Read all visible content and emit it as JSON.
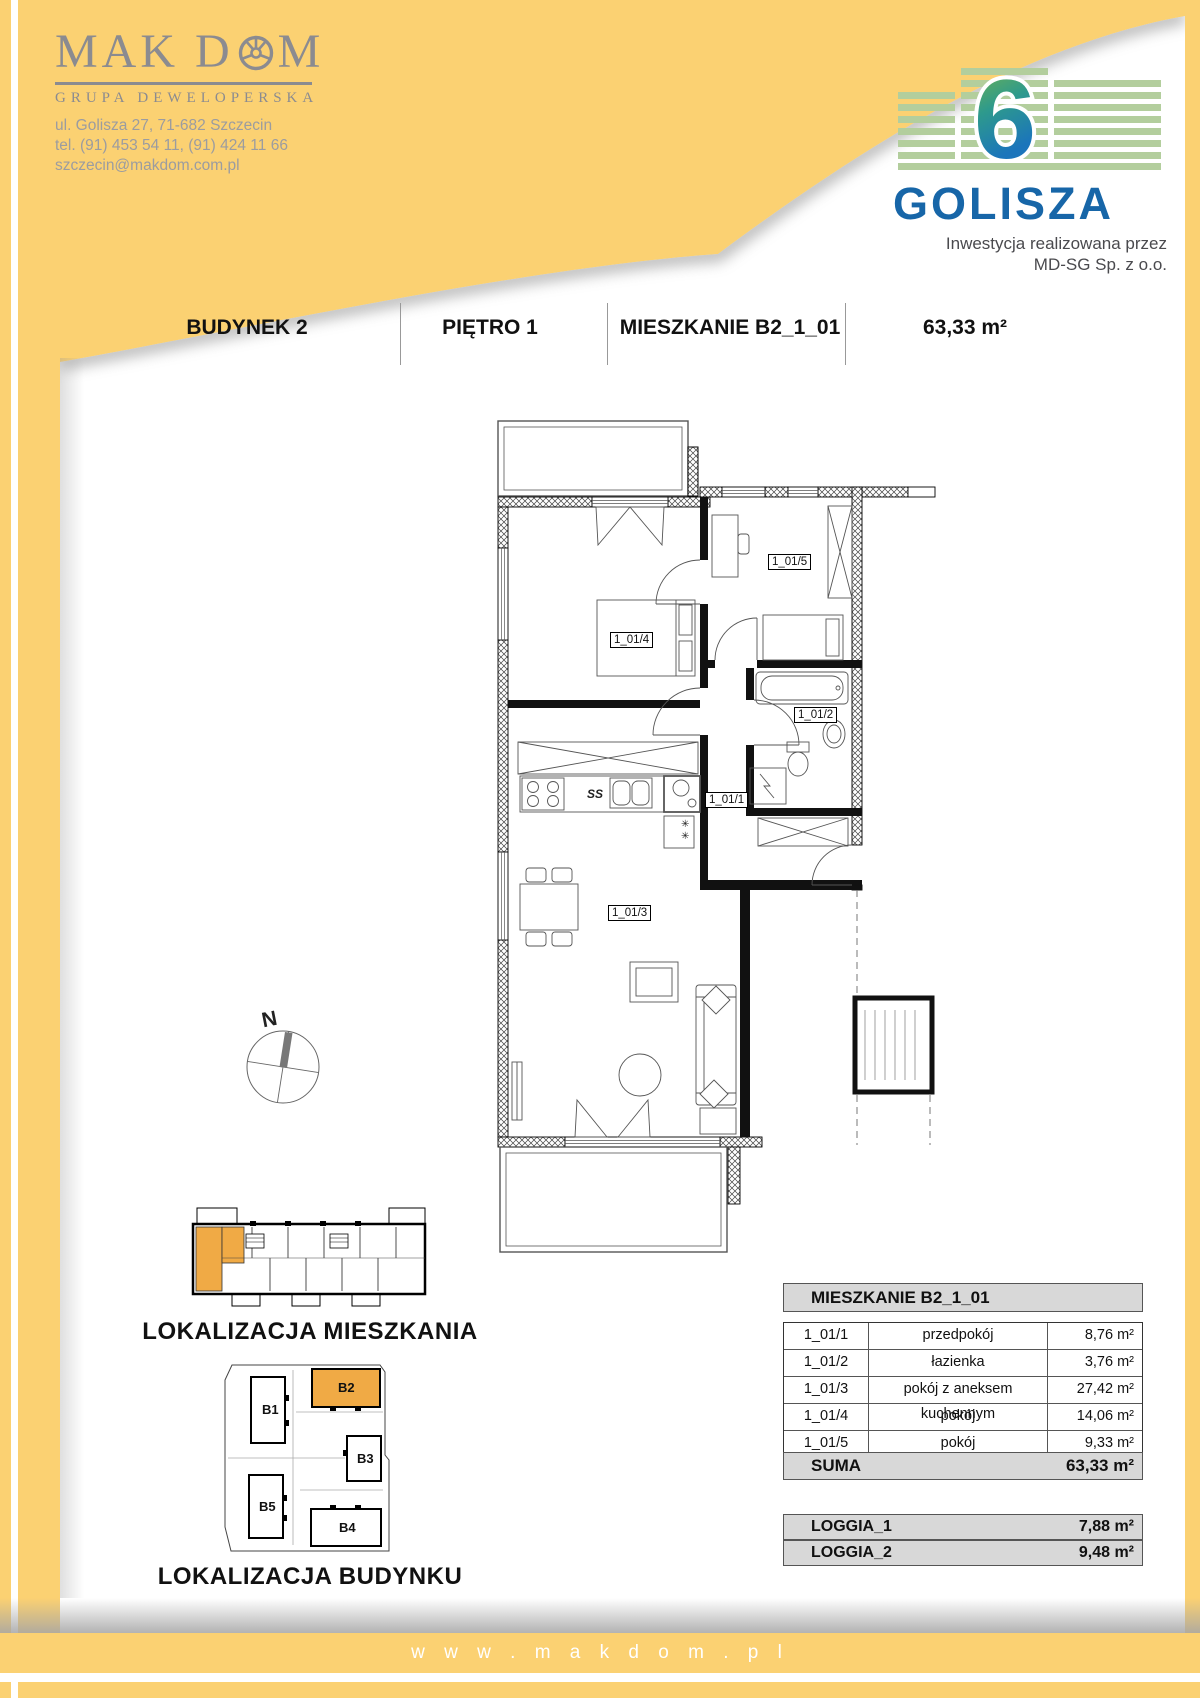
{
  "company": {
    "name_part1": "MAK D",
    "name_part2": "M",
    "subtitle": "GRUPA DEWELOPERSKA",
    "address": "ul. Golisza 27, 71-682 Szczecin",
    "phone": "tel. (91) 453 54 11, (91) 424 11 66",
    "email": "szczecin@makdom.com.pl"
  },
  "investment": {
    "number": "6",
    "name": "GOLISZA",
    "tagline_line1": "Inwestycja realizowana przez",
    "tagline_line2": "MD-SG Sp. z o.o."
  },
  "header": {
    "building": "BUDYNEK 2",
    "floor": "PIĘTRO 1",
    "apartment": "MIESZKANIE B2_1_01",
    "area": "63,33 m²"
  },
  "floorplan": {
    "labels": {
      "hall": "1_01/1",
      "bath": "1_01/2",
      "living": "1_01/3",
      "bedroom": "1_01/4",
      "room": "1_01/5"
    },
    "marks": {
      "hob": "SS",
      "fridge": "✳ ✳"
    }
  },
  "location": {
    "compass_label": "N",
    "apartment_location_title": "LOKALIZACJA MIESZKANIA",
    "building_location_title": "LOKALIZACJA BUDYNKU",
    "buildings": [
      "B1",
      "B2",
      "B3",
      "B4",
      "B5"
    ],
    "highlighted_building": "B2"
  },
  "tables": {
    "apartment_table": {
      "title": "MIESZKANIE B2_1_01",
      "rows": [
        {
          "code": "1_01/1",
          "name": "przedpokój",
          "area": "8,76 m²"
        },
        {
          "code": "1_01/2",
          "name": "łazienka",
          "area": "3,76 m²"
        },
        {
          "code": "1_01/3",
          "name": "pokój z aneksem kuchennym",
          "area": "27,42 m²"
        },
        {
          "code": "1_01/4",
          "name": "pokój",
          "area": "14,06 m²"
        },
        {
          "code": "1_01/5",
          "name": "pokój",
          "area": "9,33 m²"
        }
      ],
      "total_label": "SUMA",
      "total_area": "63,33 m²"
    },
    "loggia_table": {
      "rows": [
        {
          "name": "LOGGIA_1",
          "area": "7,88 m²"
        },
        {
          "name": "LOGGIA_2",
          "area": "9,48 m²"
        }
      ]
    }
  },
  "footer": {
    "website": "w w w . m a k d o m . p l"
  },
  "colors": {
    "accent_yellow": "#FBD172",
    "highlight_orange": "#F0AA45",
    "brand_blue": "#1766A8",
    "brand_green": "#B3CE9D",
    "logo_gray": "#8B8B90",
    "table_gray": "#D8D8D8"
  }
}
